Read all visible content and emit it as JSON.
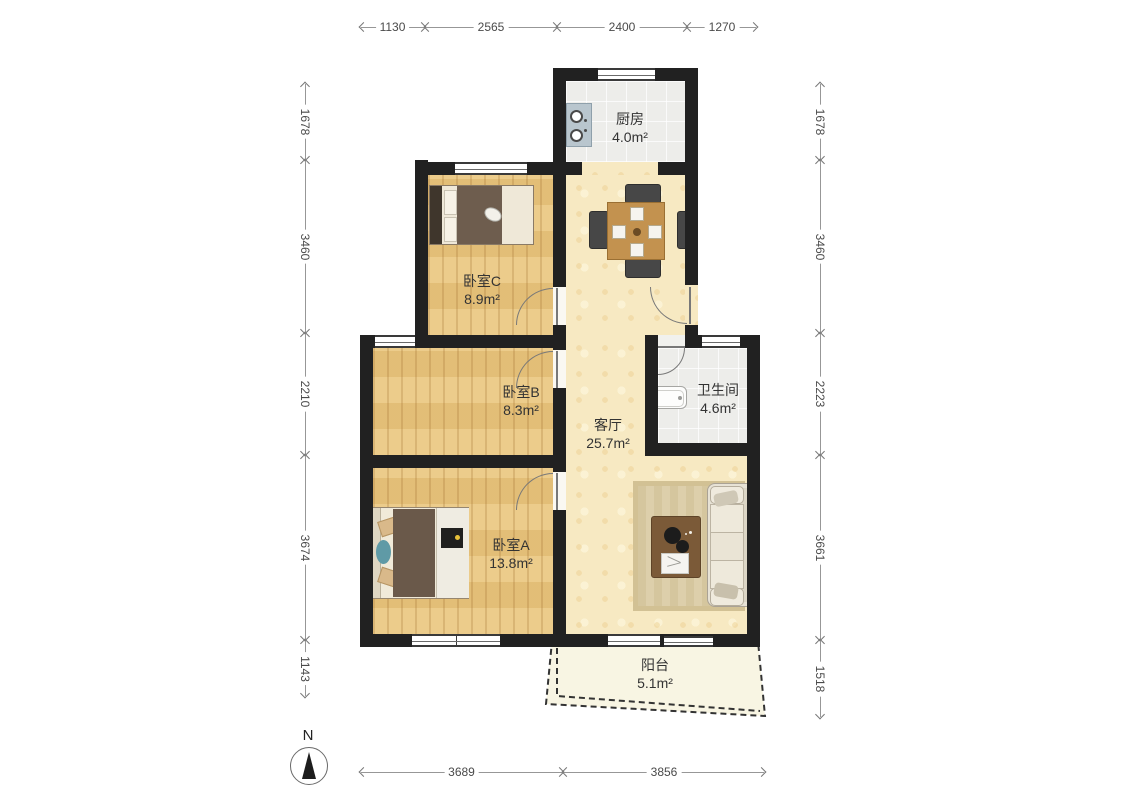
{
  "plan": {
    "type": "apartment-floor-plan",
    "compass": {
      "label": "N"
    },
    "rooms": [
      {
        "id": "kitchen",
        "name": "厨房",
        "area": "4.0",
        "unit": "m²"
      },
      {
        "id": "bedroomC",
        "name": "卧室C",
        "area": "8.9",
        "unit": "m²"
      },
      {
        "id": "bedroomB",
        "name": "卧室B",
        "area": "8.3",
        "unit": "m²"
      },
      {
        "id": "bathroom",
        "name": "卫生间",
        "area": "4.6",
        "unit": "m²"
      },
      {
        "id": "living",
        "name": "客厅",
        "area": "25.7",
        "unit": "m²"
      },
      {
        "id": "bedroomA",
        "name": "卧室A",
        "area": "13.8",
        "unit": "m²"
      },
      {
        "id": "balcony",
        "name": "阳台",
        "area": "5.1",
        "unit": "m²"
      }
    ],
    "dimensions": {
      "top": [
        "1130",
        "2565",
        "2400",
        "1270"
      ],
      "left": [
        "1678",
        "3460",
        "2210",
        "3674",
        "1143"
      ],
      "right": [
        "1678",
        "3460",
        "2223",
        "3661",
        "1518"
      ],
      "bottom": [
        "3689",
        "3856"
      ]
    },
    "colors": {
      "wall": "#212121",
      "wood_floor": "#eac67e",
      "hall_floor": "#f7e9c2",
      "tile_floor": "#ededea",
      "balcony_floor": "#f8f5e3"
    }
  }
}
